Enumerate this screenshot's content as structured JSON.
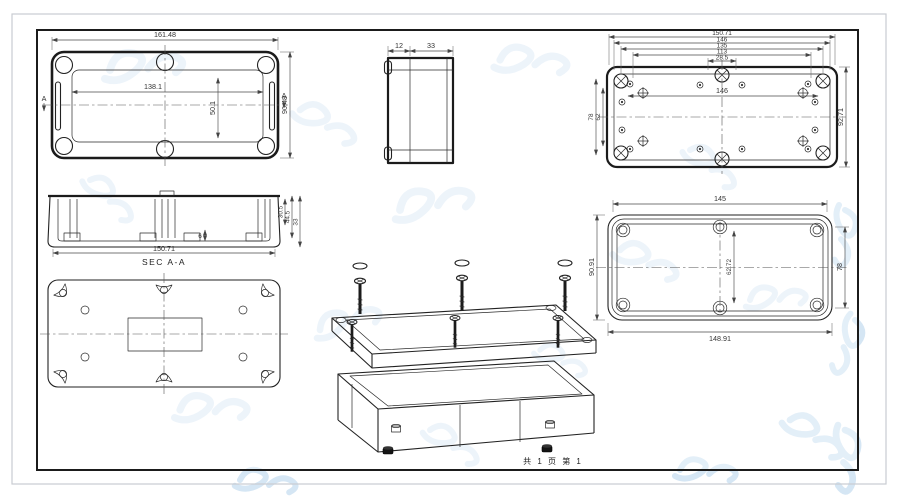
{
  "sheet": {
    "footer": "共 1 页  第 1"
  },
  "views": {
    "top": {
      "w_outer": "161.48",
      "w_inner": "138.1",
      "h_inner": "50.1",
      "h_outer": "90.48",
      "sec_left": "A",
      "sec_right": "A"
    },
    "side": {
      "lid": "12",
      "body": "33"
    },
    "inside": {
      "stack": [
        "150.71",
        "146",
        "135",
        "113",
        "28.5"
      ],
      "inner_w": "146",
      "height": "92.71",
      "left_a": "78",
      "left_b": "62"
    },
    "section": {
      "label": "SEC A-A",
      "width": "150.71",
      "depth": "30.5",
      "total": "44.5",
      "body_h": "33",
      "rib": "6"
    },
    "gasket": {
      "top": "145",
      "bottom": "148.91",
      "left": "90.91",
      "right": "78",
      "center": "62.72"
    }
  }
}
